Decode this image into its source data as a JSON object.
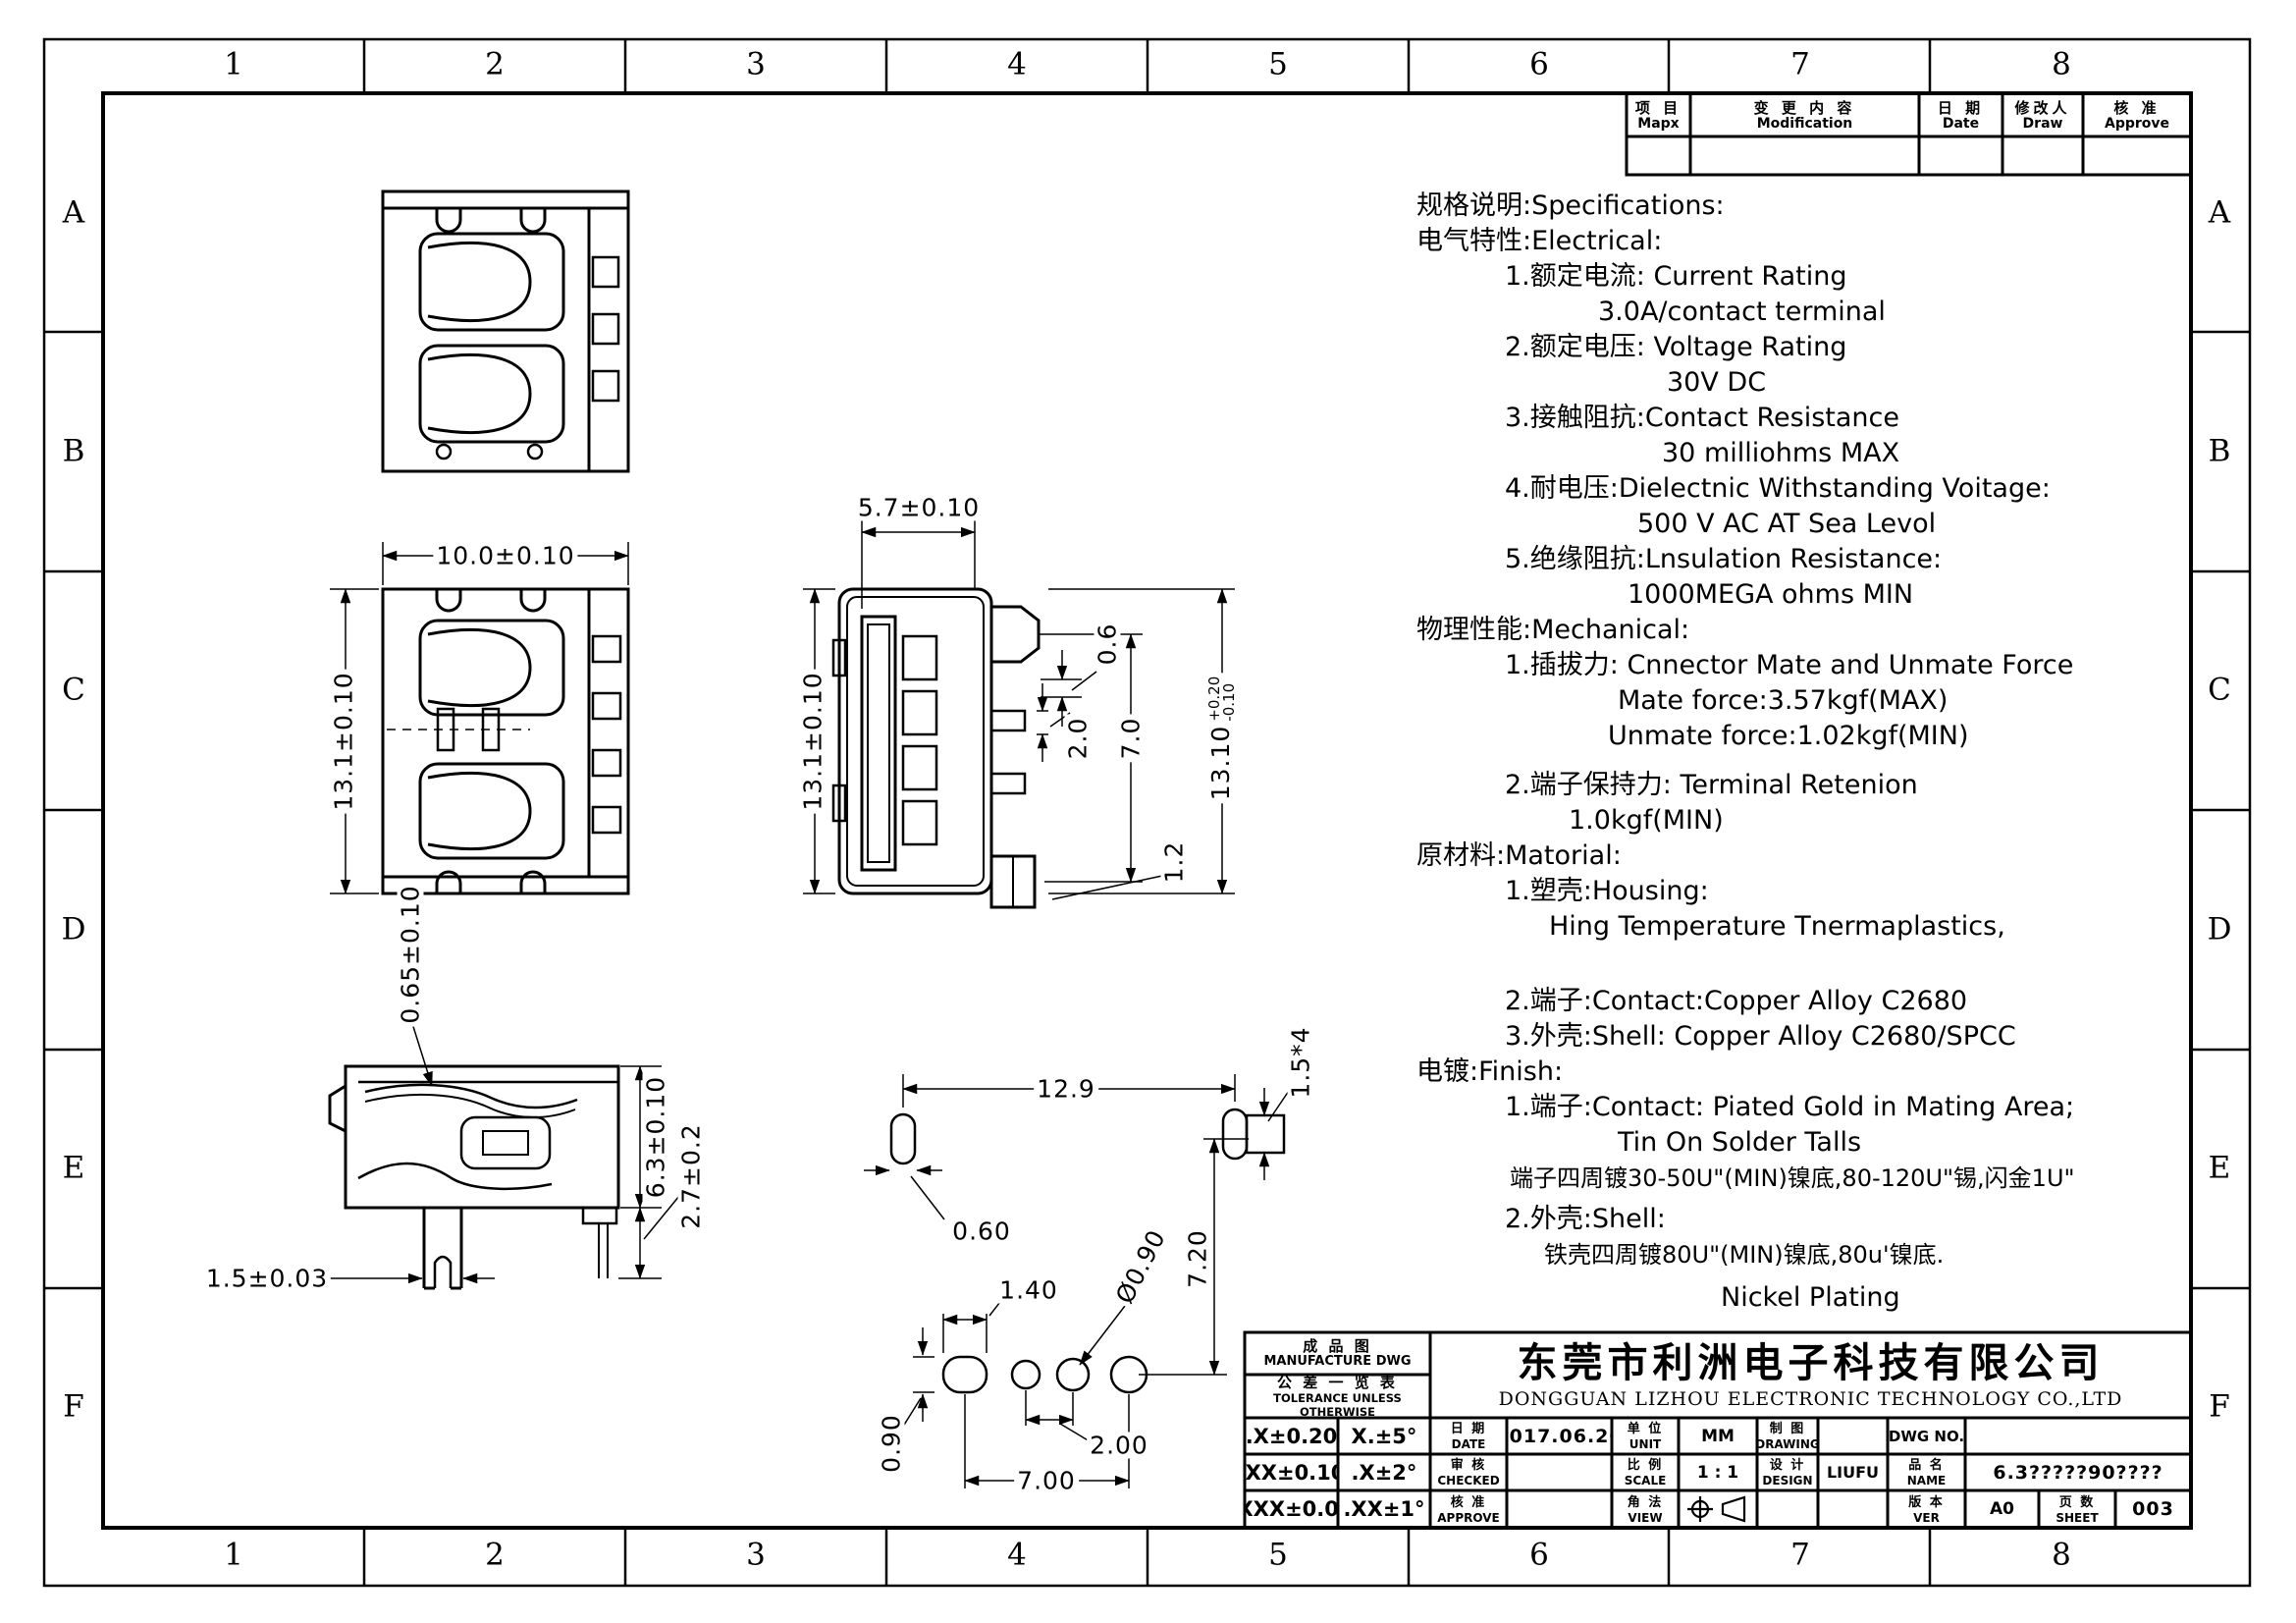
{
  "colors": {
    "ink": "#000000",
    "paper": "#ffffff"
  },
  "border": {
    "cols": [
      "1",
      "2",
      "3",
      "4",
      "5",
      "6",
      "7",
      "8"
    ],
    "rows": [
      "A",
      "B",
      "C",
      "D",
      "E",
      "F"
    ]
  },
  "mod_table": {
    "item": {
      "cn": "项 目",
      "en": "Mapx"
    },
    "modification": {
      "cn": "变 更 内 容",
      "en": "Modification"
    },
    "date": {
      "cn": "日 期",
      "en": "Date"
    },
    "draw": {
      "cn": "修改人",
      "en": "Draw"
    },
    "approve": {
      "cn": "核 准",
      "en": "Approve"
    }
  },
  "specs": {
    "lines": [
      "规格说明:Specifications:",
      "电气特性:Electrical:",
      "1.额定电流: Current  Rating",
      "3.0A/contact  terminal",
      "2.额定电压: Voltage  Rating",
      "30V  DC",
      "3.接触阻抗:Contact  Resistance",
      "30  milliohms  MAX",
      "4.耐电压:Dielectnic  Withstanding  Voitage:",
      "500  V  AC  AT  Sea  Levol",
      "5.绝缘阻抗:Lnsulation  Resistance:",
      "1000MEGA  ohms  MIN",
      "物理性能:Mechanical:",
      "1.插拔力: Cnnector  Mate  and  Unmate  Force",
      "Mate  force:3.57kgf(MAX)",
      "Unmate  force:1.02kgf(MIN)",
      "2.端子保持力: Terminal  Retenion",
      "1.0kgf(MIN)",
      "原材料:Matorial:",
      "1.塑壳:Housing:",
      "Hing  Temperature   Tnermaplastics,",
      "2.端子:Contact:Copper  Alloy  C2680",
      "3.外壳:Shell:  Copper  Alloy  C2680/SPCC",
      "电镀:Finish:",
      "1.端子:Contact:  Piated  Gold  in  Mating  Area;",
      "Tin  On  Solder  Talls",
      "端子四周镀30-50U\"(MIN)镍底,80-120U\"锡,闪金1U\"",
      "2.外壳:Shell:",
      "铁壳四周镀80U\"(MIN)镍底,80u'镍底.",
      "Nickel  Plating"
    ]
  },
  "views": {
    "v2": {
      "width": "10.0±0.10",
      "height": "13.1±0.10"
    },
    "v3": {
      "width": "5.7±0.10",
      "height": "13.1±0.10",
      "pin_gap": "0.6",
      "pin_w": "2.0",
      "pin_span": "7.0",
      "pin_offset": "1.2",
      "overall": "13.10",
      "tol_up": "+0.20",
      "tol_dn": "-0.10"
    },
    "v4": {
      "lip": "0.65±0.10",
      "body_h": "6.3±0.10",
      "leg": "2.7±0.2",
      "fork": "1.5±0.03"
    },
    "v5": {
      "span": "12.9",
      "pad_w": "0.60",
      "pad4": "1.5*4",
      "slot_w": "1.40",
      "slot_h": "0.90",
      "hole": "Ø0.90",
      "v_span": "7.20",
      "pitch": "2.00",
      "row_span": "7.00"
    }
  },
  "title_block": {
    "manufacture": {
      "cn": "成 品 图",
      "en": "MANUFACTURE DWG"
    },
    "tolerance": {
      "cn": "公 差 一 览 表",
      "en": "TOLERANCE UNLESS OTHERWISE"
    },
    "tol_rows": [
      [
        ".X±0.20",
        "X.±5°"
      ],
      [
        ".XX±0.10",
        ".X±2°"
      ],
      [
        ".XXX±0.05",
        ".XX±1°"
      ]
    ],
    "company": {
      "cn": "东莞市利洲电子科技有限公司",
      "en": "DONGGUAN LIZHOU ELECTRONIC TECHNOLOGY CO.,LTD"
    },
    "fields": {
      "date": {
        "cn": "日 期",
        "en": "DATE",
        "value": "2017.06.20"
      },
      "unit": {
        "cn": "单 位",
        "en": "UNIT",
        "value": "MM"
      },
      "drawing": {
        "cn": "制 图",
        "en": "DRAWING",
        "value": ""
      },
      "dwg_no": {
        "en": "DWG NO.",
        "value": ""
      },
      "checked": {
        "cn": "审 核",
        "en": "CHECKED",
        "value": ""
      },
      "scale": {
        "cn": "比 例",
        "en": "SCALE",
        "value": "1 : 1"
      },
      "design": {
        "cn": "设 计",
        "en": "DESIGN",
        "value": "LIUFU"
      },
      "name": {
        "cn": "品 名",
        "en": "NAME",
        "value": "6.3?????90????"
      },
      "approve": {
        "cn": "核 准",
        "en": "APPROVE",
        "value": ""
      },
      "view": {
        "cn": "角 法",
        "en": "VIEW"
      },
      "ver": {
        "cn": "版 本",
        "en": "VER",
        "value": "A0"
      },
      "sheet": {
        "cn": "页 数",
        "en": "SHEET",
        "value": "003"
      }
    }
  }
}
